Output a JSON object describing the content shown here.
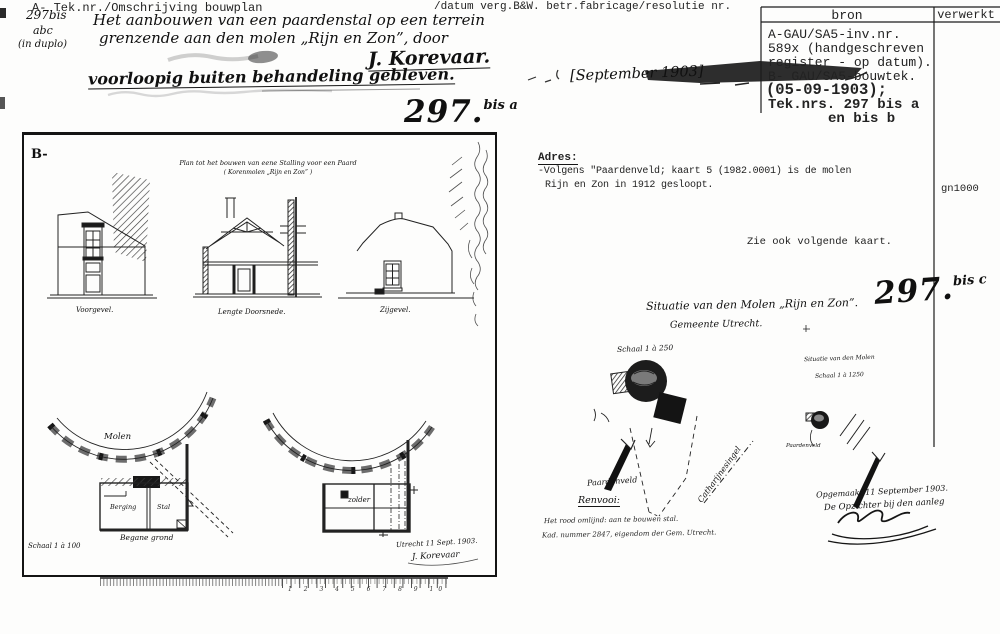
{
  "header": {
    "left_label": "A- Tek.nr./Omschrijving bouwplan",
    "right_label": "/datum verg.B&W. betr.fabricage/resolutie nr.",
    "margin_number": "297bis",
    "margin_number2": "abc",
    "margin_number3": "(in duplo)",
    "description_line1": "Het aanbouwen van een paardenstal op een terrein",
    "description_line2": "grenzende aan den molen „Rijn en Zon”, door",
    "applicant": "J. Korevaar.",
    "status_note": "voorloopig buiten behandeling gebleven.",
    "date_note": "[September 1903]"
  },
  "registry_table": {
    "col1_header": "bron",
    "col2_header": "verwerkt",
    "rows": [
      "A-GAU/SA5-inv.nr.",
      "589x (handgeschreven",
      "register - op datum).",
      "B- GAU/SA5-bouwtek."
    ],
    "rows_bold": [
      "(05-09-1903);",
      "Tek.nrs. 297 bis a",
      "en bis b"
    ]
  },
  "adres_block": {
    "label": "Adres:",
    "line1": "-Volgens \"Paardenveld; kaart 5 (1982.0001) is de molen",
    "line2": "Rijn en Zon in 1912 gesloopt.",
    "code": "gn1000",
    "see_also": "Zie ook volgende kaart."
  },
  "sheet_numbers": {
    "a_main": "297.",
    "a_sup": "bis a",
    "c_main": "297.",
    "c_sup": "bis c"
  },
  "drawing_sheet": {
    "corner_mark": "B-",
    "title_line1": "Plan tot het bouwen van eene Stalling voor een Paard",
    "title_line2": "( Korenmolen „Rijn en Zon” )",
    "caption_front": "Voorgevel.",
    "caption_section": "Lengte Doorsnede.",
    "caption_side": "Zijgevel.",
    "plan_ground": {
      "molen_label": "Molen",
      "room_left": "Berging",
      "room_right": "Stal",
      "caption": "Begane grond",
      "scale": "Schaal 1 à 100"
    },
    "plan_upper": {
      "label": "zolder"
    },
    "signoff_line1": "Utrecht 11 Sept. 1903.",
    "signoff_line2": "J. Korevaar"
  },
  "situatie_sheet": {
    "title_line1": "Situatie van den Molen „Rijn en Zon”.",
    "title_line2": "Gemeente Utrecht.",
    "scale": "Schaal 1 à 250",
    "north_label": "Paardenveld",
    "street_label": "Catharijnesingel",
    "renvooi_label": "Renvooi:",
    "renvooi_line1": "Het rood omlijnd: aan te bouwen stal.",
    "renvooi_line2": "Kad. nummer 2847, eigendom der Gem. Utrecht.",
    "inset_title": "Situatie van den Molen",
    "inset_scale": "Schaal 1 à 1250",
    "inset_label": "Paardenveld",
    "signoff_line1": "Opgemaakt 11 September 1903.",
    "signoff_line2": "De Opzichter bij den aanleg"
  },
  "ruler": {
    "numbers": "1 2 3 4 5 6 7 8 9 10"
  }
}
